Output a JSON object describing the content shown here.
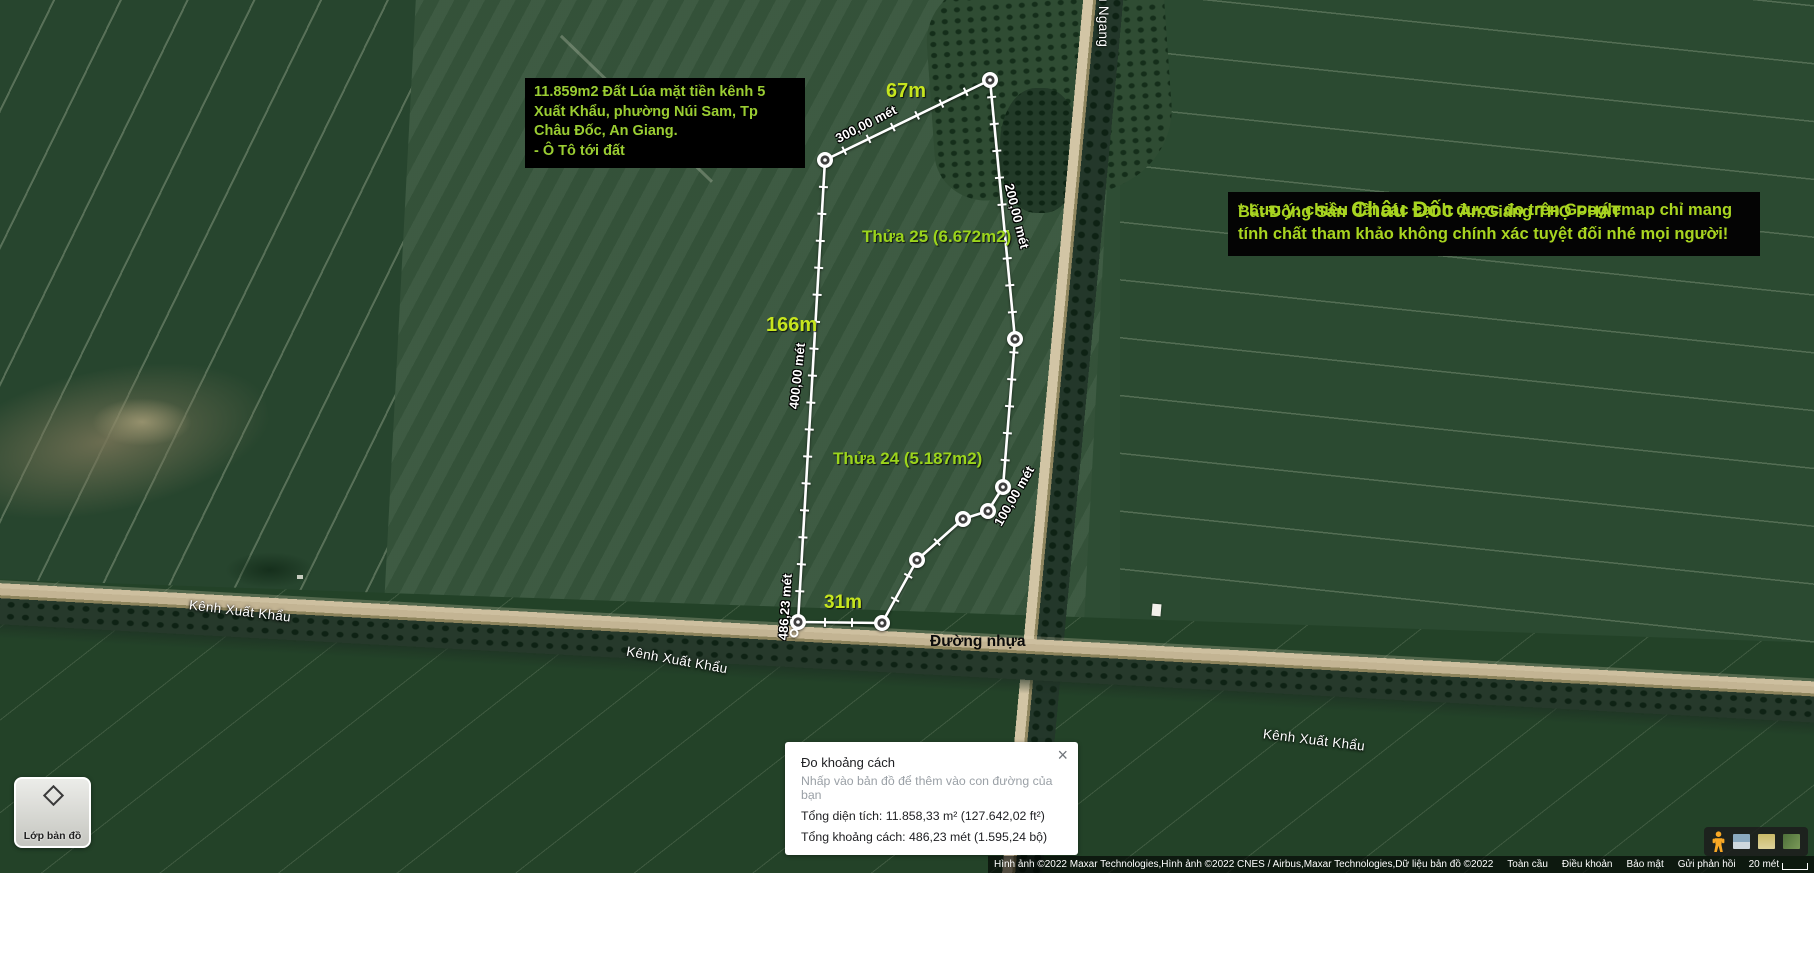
{
  "colors": {
    "accent_text": "#9acd32",
    "bright_label": "#c6e51e",
    "path": "#ffffff"
  },
  "left_info_box": {
    "lines": [
      "11.859m2 Đất Lúa mặt tiền kênh 5",
      "Xuất Khẩu, phường Núi Sam, Tp",
      "Châu Đốc, An Giang.",
      "- Ô Tô tới đất"
    ]
  },
  "right_info_box": {
    "title_pre": "Bất Động Sản",
    "title_big": "Châu Đốc",
    "title_post": "An Giang THỌ PHÁT",
    "note_line1": "* Lưu ý: chiều dài các cạnh được đo trên Googlemap chỉ mang",
    "note_line2": "tính chất tham khảo không chính xác tuyệt đối nhé mọi người!"
  },
  "map_labels": {
    "edge_67": "67m",
    "edge_166": "166m",
    "edge_31": "31m",
    "parcel_25": "Thửa 25 (6.672m2)",
    "parcel_24": "Thửa 24 (5.187m2)",
    "dist_300": "300,00 mét",
    "dist_200": "200,00 mét",
    "dist_400": "400,00 mét",
    "dist_100": "100,00 mét",
    "dist_total": "486,23 mét",
    "canal_1": "Kênh Xuất Khẩu",
    "canal_2": "Kênh Xuất Khẩu",
    "canal_3": "Kênh Xuất Khẩu",
    "road_paved": "Đường nhựa",
    "canal_vertical": "u Ngang"
  },
  "measure_path": {
    "vertices": [
      [
        798,
        622
      ],
      [
        882,
        623
      ],
      [
        917,
        560
      ],
      [
        963,
        519
      ],
      [
        988,
        511
      ],
      [
        1003,
        487
      ],
      [
        1015,
        339
      ],
      [
        990,
        80
      ],
      [
        825,
        160
      ],
      [
        798,
        622
      ]
    ],
    "start_marker": [
      794,
      633
    ],
    "tick_spacing_px": 27
  },
  "measure_popup": {
    "title": "Đo khoảng cách",
    "hint": "Nhấp vào bản đồ để thêm vào con đường của bạn",
    "total_area": "Tổng diện tích: 11.858,33 m² (127.642,02 ft²)",
    "total_distance": "Tổng khoảng cách: 486,23 mét (1.595,24 bộ)",
    "close": "×"
  },
  "layers_button": {
    "label": "Lớp bản đồ"
  },
  "attribution": {
    "imagery": "Hình ảnh ©2022 Maxar Technologies,Hình ảnh ©2022 CNES / Airbus,Maxar Technologies,Dữ liệu bản đồ ©2022",
    "links": [
      "Toàn cầu",
      "Điều khoản",
      "Bảo mật",
      "Gửi phản hồi"
    ],
    "scale": "20 mét"
  }
}
